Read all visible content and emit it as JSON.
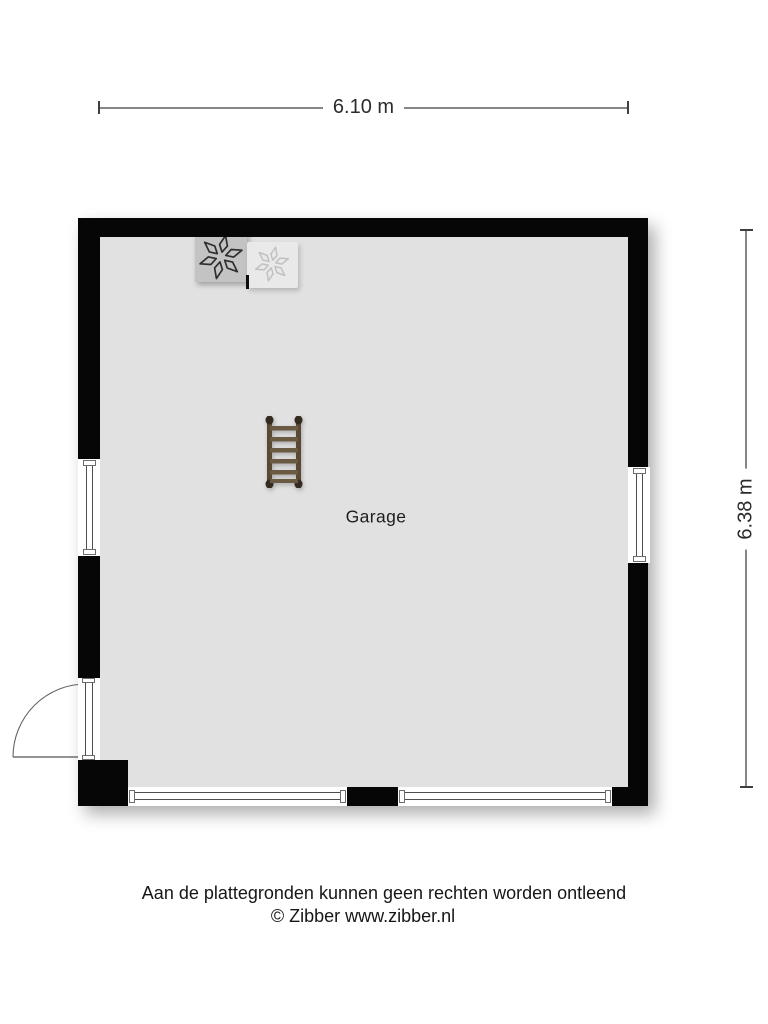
{
  "floor_plan": {
    "room_label": "Garage",
    "width_dimension": "6.10 m",
    "height_dimension": "6.38 m"
  },
  "footer": {
    "disclaimer": "Aan de plattegronden kunnen geen rechten worden ontleend",
    "copyright": "© Zibber www.zibber.nl"
  },
  "icons": {
    "fan_dark": "fan-icon",
    "fan_light": "fan-icon",
    "ladder": "ladder-icon",
    "door_swing": "door-swing-arc"
  },
  "colors": {
    "wall": "#060606",
    "floor": "#e1e1e1",
    "dimension_line": "#868686",
    "fan_box_dark": "#c3c3c3",
    "fan_box_light": "#e9e9e9",
    "ladder_rail": "#584834",
    "ladder_rung": "#6b5a42",
    "window_line": "#4e4e4e"
  }
}
